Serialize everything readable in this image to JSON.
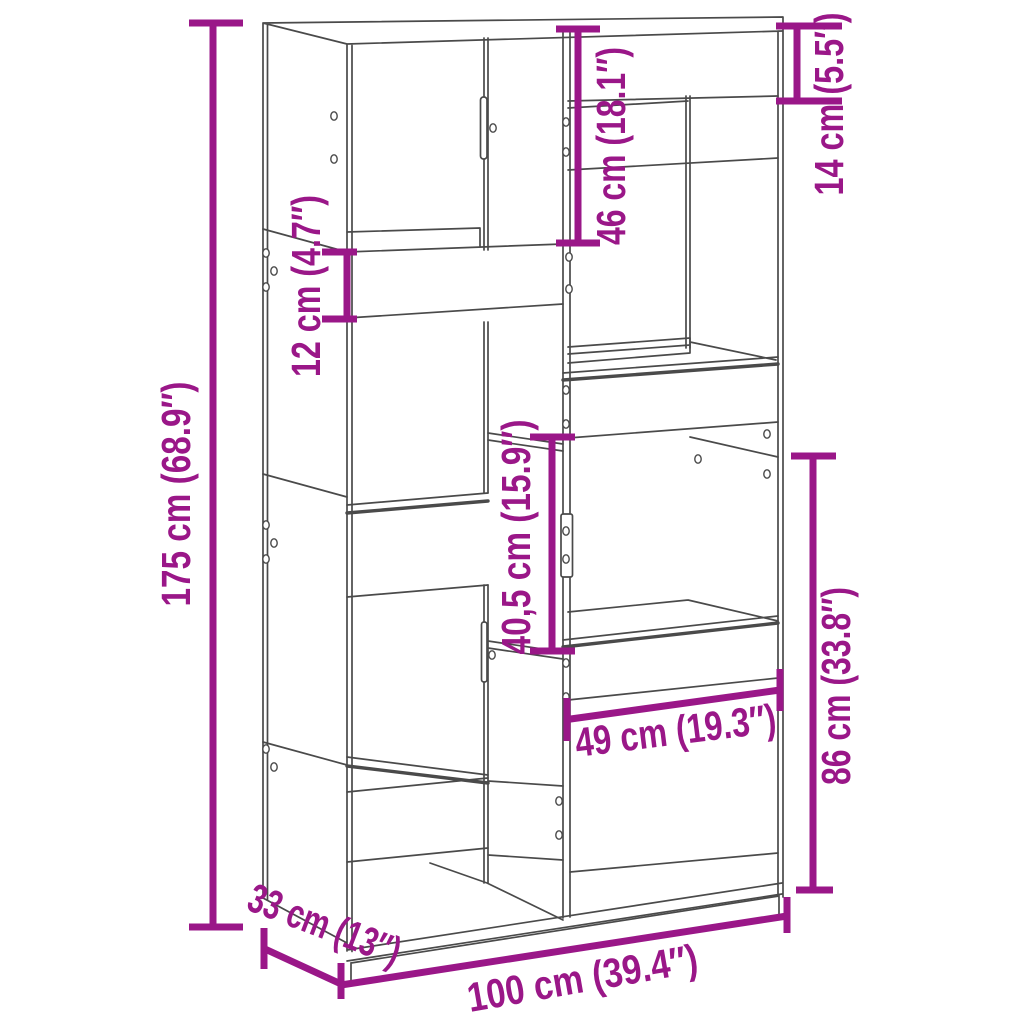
{
  "colors": {
    "dimension_accent": "#9A1788",
    "line_art": "#4A4A4A",
    "background": "#FFFFFF"
  },
  "dims": {
    "height": {
      "label": "175 cm (68.9″)"
    },
    "shelf_gap": {
      "label": "12 cm (4.7″)"
    },
    "upper_compartment": {
      "label": "46 cm (18.1″)"
    },
    "top_shelf": {
      "label": "14 cm (5.5″)"
    },
    "middle_compartment": {
      "label": "40,5 cm (15.9″)"
    },
    "lower_section": {
      "label": "86 cm (33.8″)"
    },
    "inner_width": {
      "label": "49 cm (19.3″)"
    },
    "depth": {
      "label": "33 cm (13″)"
    },
    "width": {
      "label": "100 cm (39.4″)"
    }
  }
}
